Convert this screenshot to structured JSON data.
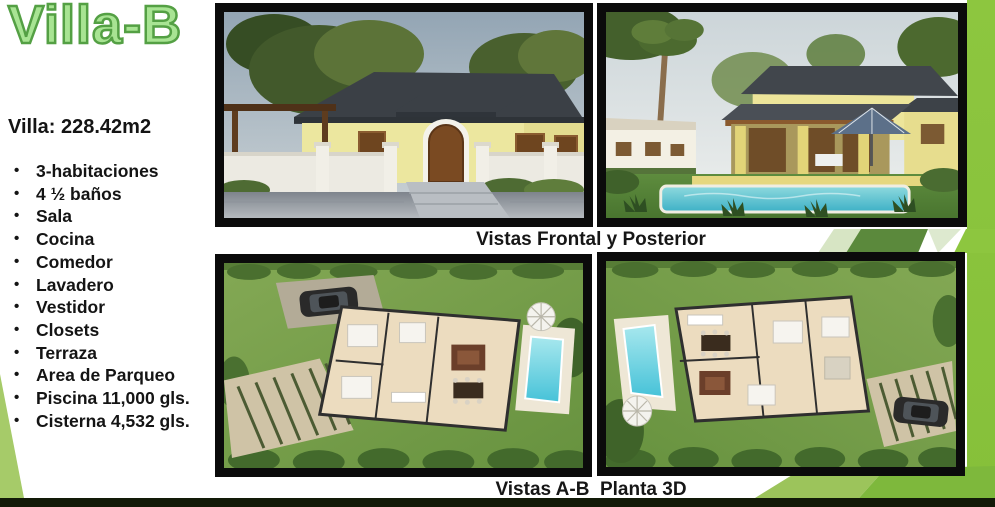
{
  "slide": {
    "title": "Villa-B",
    "area_label": "Villa: 228.42m2",
    "features": [
      "3-habitaciones",
      "4 ½ baños",
      "Sala",
      "Cocina",
      "Comedor",
      "Lavadero",
      "Vestidor",
      "Closets",
      "Terraza",
      "Area de Parqueo",
      "Piscina 11,000 gls.",
      "Cisterna 4,532 gls."
    ],
    "captions": {
      "top": "Vistas Frontal y Posterior",
      "bottom": "Vistas A-B  Planta 3D"
    },
    "images": {
      "top_left": "front-view-render",
      "top_right": "rear-view-pool-render",
      "bottom_left": "floor-plan-3d-a",
      "bottom_right": "floor-plan-3d-b"
    },
    "colors": {
      "accent_green": "#8dc63f",
      "title_fill": "#a8e493",
      "title_stroke": "#54a044",
      "wedge_green": "#a6cb69",
      "dark_bottom_bar": "#121a08",
      "text": "#141414"
    }
  }
}
